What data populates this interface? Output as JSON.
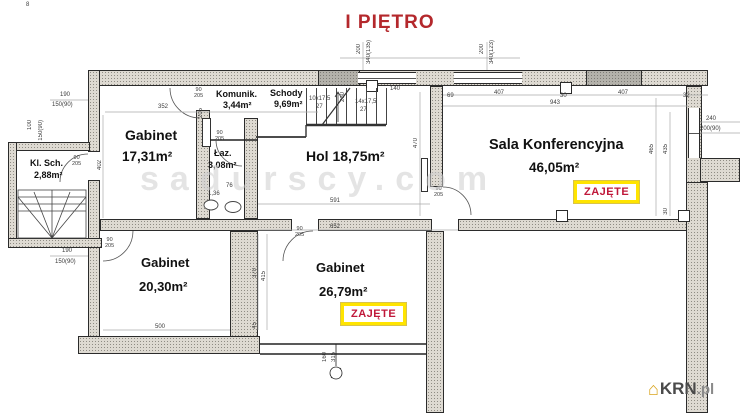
{
  "title": "I PIĘTRO",
  "watermark": "sadurscy.com",
  "status_label": "ZAJĘTE",
  "door_label": "90\n205",
  "logo": {
    "icon": "⌂",
    "name": "KRN",
    "tld": ".pl"
  },
  "colors": {
    "title_red": "#b4282c",
    "status_red": "#c0183a",
    "status_border_yellow": "#ffe400",
    "wall_fill": "#dedad2",
    "line_dark": "#2b2b2b",
    "watermark_gray": "#cfcfcf"
  },
  "rooms": {
    "kl_sch": {
      "name": "Kl. Sch.",
      "area": "2,88m²"
    },
    "gabinet1": {
      "name": "Gabinet",
      "area": "17,31m²"
    },
    "komunik": {
      "name": "Komunik.",
      "area": "3,44m²"
    },
    "schody": {
      "name": "Schody",
      "area": "9,69m²"
    },
    "laz": {
      "name": "Łaz.",
      "area": "3,08m²"
    },
    "hol": {
      "name": "Hol",
      "area": "18,75m²"
    },
    "sala": {
      "name": "Sala Konferencyjna",
      "area": "46,05m²"
    },
    "gabinet2": {
      "name": "Gabinet",
      "area": "20,30m²"
    },
    "gabinet3": {
      "name": "Gabinet",
      "area": "26,79m²"
    }
  },
  "dims": [
    "352",
    "190",
    "150(90)",
    "190",
    "150(90)",
    "140",
    "69",
    "407",
    "30",
    "407",
    "32",
    "943",
    "240",
    "200(90)",
    "591",
    "652",
    "500",
    "10x17,5",
    "27",
    "14x17,5",
    "27",
    "1,36",
    "76",
    "402",
    "100",
    "150(90)",
    "200",
    "340(135)",
    "200",
    "340(123)",
    "260",
    "470",
    "465",
    "435",
    "30",
    "370",
    "415",
    "45",
    "160",
    "315",
    "205",
    "8"
  ]
}
